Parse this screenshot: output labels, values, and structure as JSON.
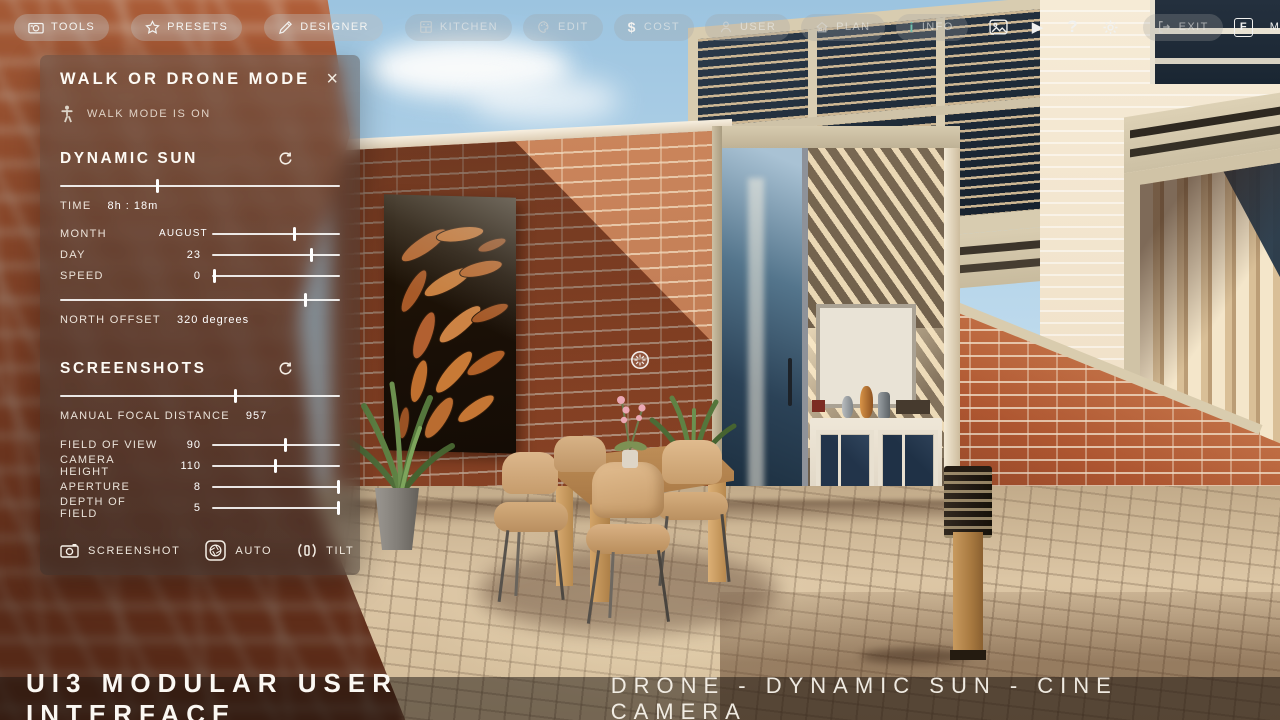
{
  "colors": {
    "info_accent": "#6fc0ae",
    "sky": "#a9cde6",
    "brick": "#a8542e",
    "panel_background": "rgba(52,44,40,0.5)"
  },
  "topbar": {
    "buttons": [
      {
        "label": "TOOLS",
        "icon": "screenshot-tool-icon",
        "state": "active"
      },
      {
        "label": "PRESETS",
        "icon": "star-icon",
        "state": "active"
      },
      {
        "label": "DESIGNER",
        "icon": "pencil-icon",
        "state": "active"
      },
      {
        "label": "KITCHEN",
        "icon": "kitchen-icon",
        "state": "dim"
      },
      {
        "label": "EDIT",
        "icon": "palette-icon",
        "state": "dim"
      },
      {
        "label": "COST",
        "icon": "dollar-icon",
        "state": "dim"
      },
      {
        "label": "USER",
        "icon": "user-icon",
        "state": "dim"
      },
      {
        "label": "PLAN",
        "icon": "house-icon",
        "state": "dim"
      },
      {
        "label": "INFO",
        "icon": "info-icon",
        "state": "dim"
      }
    ],
    "dollar_glyph": "$",
    "info_glyph": "i",
    "play_glyph": "▶",
    "help_glyph": "?",
    "exit_label": "EXIT",
    "fullscreen_label": "F",
    "menu_label": "MENU"
  },
  "panel": {
    "title": "WALK OR DRONE MODE",
    "close_glyph": "×",
    "mode_status": "WALK MODE IS ON",
    "dynamic_sun": {
      "title": "DYNAMIC SUN",
      "time": {
        "label": "TIME",
        "value": "8h : 18m",
        "pos": 35
      },
      "month": {
        "label": "MONTH",
        "value": "AUGUST",
        "pos": 65
      },
      "day": {
        "label": "DAY",
        "value": "23",
        "pos": 78
      },
      "speed": {
        "label": "SPEED",
        "value": "0",
        "pos": 2
      },
      "north_offset": {
        "label": "NORTH OFFSET",
        "value": "320 degrees",
        "pos": 88
      }
    },
    "screenshots": {
      "title": "SCREENSHOTS",
      "manual_focal_distance": {
        "label": "MANUAL FOCAL DISTANCE",
        "value": "957",
        "pos": 63
      },
      "field_of_view": {
        "label": "FIELD OF VIEW",
        "value": "90",
        "pos": 58
      },
      "camera_height": {
        "label": "CAMERA HEIGHT",
        "value": "110",
        "pos": 50
      },
      "aperture": {
        "label": "APERTURE",
        "value": "8",
        "pos": 99
      },
      "depth_of_field": {
        "label": "DEPTH OF FIELD",
        "value": "5",
        "pos": 99
      },
      "screenshot_button": "SCREENSHOT",
      "auto_button": "AUTO",
      "tilt_button": "TILT"
    }
  },
  "bottombar": {
    "title": "UI3 MODULAR USER INTERFACE",
    "subtitle": "DRONE - DYNAMIC SUN - CINE CAMERA"
  }
}
